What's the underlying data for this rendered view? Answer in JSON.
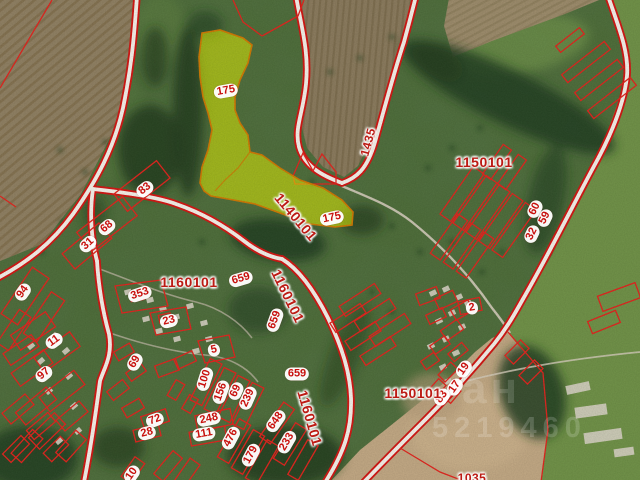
{
  "map": {
    "type": "cadastral-satellite-map",
    "selected_parcel": {
      "number": "175",
      "quarter": "1140101",
      "highlight_fill": "#e3f300",
      "highlight_stroke": "#d07800"
    },
    "colors": {
      "boundary": "#e2231c",
      "road_casing": "#d21511",
      "road_fill": "#f6f2ea",
      "label_text": "#c8100d",
      "quarter_text": "#bc1b14"
    },
    "quarter_labels": [
      {
        "text": "1140101",
        "x": 296,
        "y": 217,
        "rot": 50,
        "size": 14
      },
      {
        "text": "1150101",
        "x": 484,
        "y": 162,
        "rot": 0,
        "size": 14
      },
      {
        "text": "1150101",
        "x": 413,
        "y": 393,
        "rot": 0,
        "size": 14
      },
      {
        "text": "1160101",
        "x": 189,
        "y": 282,
        "rot": 0,
        "size": 14
      },
      {
        "text": "1160101",
        "x": 288,
        "y": 296,
        "rot": 64,
        "size": 14
      },
      {
        "text": "1160101",
        "x": 310,
        "y": 418,
        "rot": 74,
        "size": 14
      },
      {
        "text": "1435",
        "x": 368,
        "y": 142,
        "rot": -75,
        "size": 12
      },
      {
        "text": "1035",
        "x": 472,
        "y": 478,
        "rot": 0,
        "size": 12
      }
    ],
    "parcel_labels": [
      {
        "text": "175",
        "x": 226,
        "y": 91,
        "rot": -10
      },
      {
        "text": "175",
        "x": 332,
        "y": 218,
        "rot": -12
      },
      {
        "text": "83",
        "x": 145,
        "y": 189,
        "rot": -38
      },
      {
        "text": "68",
        "x": 107,
        "y": 227,
        "rot": -40
      },
      {
        "text": "31",
        "x": 88,
        "y": 244,
        "rot": -42
      },
      {
        "text": "94",
        "x": 23,
        "y": 292,
        "rot": -55
      },
      {
        "text": "353",
        "x": 140,
        "y": 294,
        "rot": -18
      },
      {
        "text": "23",
        "x": 169,
        "y": 321,
        "rot": -14
      },
      {
        "text": "5",
        "x": 214,
        "y": 350,
        "rot": -12
      },
      {
        "text": "11",
        "x": 54,
        "y": 341,
        "rot": -36
      },
      {
        "text": "97",
        "x": 44,
        "y": 374,
        "rot": -40
      },
      {
        "text": "69",
        "x": 135,
        "y": 362,
        "rot": -60
      },
      {
        "text": "100",
        "x": 205,
        "y": 379,
        "rot": -72
      },
      {
        "text": "156",
        "x": 221,
        "y": 392,
        "rot": -70
      },
      {
        "text": "69",
        "x": 236,
        "y": 391,
        "rot": -66
      },
      {
        "text": "239",
        "x": 248,
        "y": 398,
        "rot": -66
      },
      {
        "text": "248",
        "x": 209,
        "y": 419,
        "rot": -12
      },
      {
        "text": "111",
        "x": 204,
        "y": 434,
        "rot": -10
      },
      {
        "text": "476",
        "x": 231,
        "y": 438,
        "rot": -62
      },
      {
        "text": "179",
        "x": 251,
        "y": 455,
        "rot": -62
      },
      {
        "text": "648",
        "x": 276,
        "y": 421,
        "rot": -55
      },
      {
        "text": "233",
        "x": 287,
        "y": 442,
        "rot": -60
      },
      {
        "text": "72",
        "x": 155,
        "y": 420,
        "rot": -20
      },
      {
        "text": "28",
        "x": 147,
        "y": 433,
        "rot": -14
      },
      {
        "text": "10",
        "x": 132,
        "y": 474,
        "rot": -55
      },
      {
        "text": "659",
        "x": 241,
        "y": 279,
        "rot": -16
      },
      {
        "text": "659",
        "x": 275,
        "y": 320,
        "rot": -70
      },
      {
        "text": "659",
        "x": 297,
        "y": 374,
        "rot": 0
      },
      {
        "text": "60",
        "x": 535,
        "y": 209,
        "rot": -64
      },
      {
        "text": "59",
        "x": 545,
        "y": 218,
        "rot": -64
      },
      {
        "text": "32",
        "x": 532,
        "y": 234,
        "rot": -64
      },
      {
        "text": "2",
        "x": 472,
        "y": 308,
        "rot": -10
      },
      {
        "text": "19",
        "x": 464,
        "y": 369,
        "rot": -55
      },
      {
        "text": "17",
        "x": 455,
        "y": 387,
        "rot": -55
      },
      {
        "text": "83",
        "x": 442,
        "y": 397,
        "rot": -55
      }
    ],
    "watermark": {
      "letters": "ан",
      "digits": "5219460"
    }
  }
}
